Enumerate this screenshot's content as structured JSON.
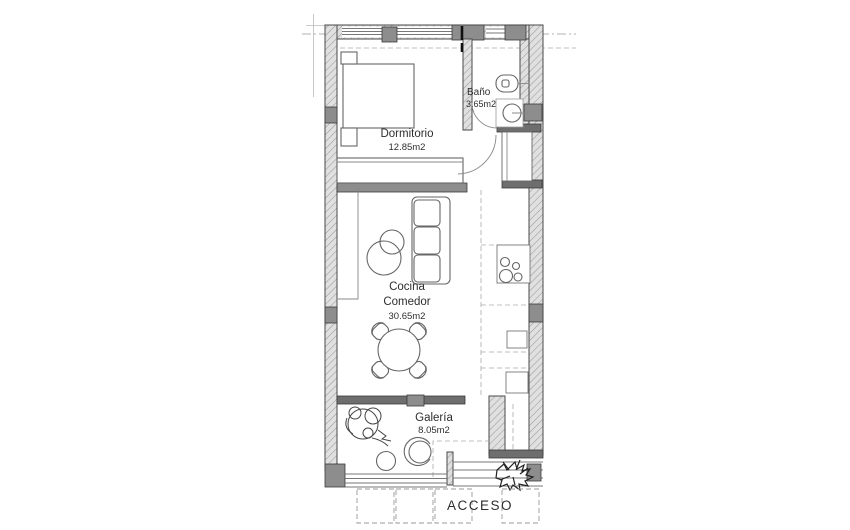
{
  "plan": {
    "rooms": {
      "dormitorio": {
        "name": "Dormitorio",
        "area": "12.85m2"
      },
      "bano": {
        "name": "Baño",
        "area": "3.65m2"
      },
      "cocina_comedor": {
        "name_line1": "Cocina",
        "name_line2": "Comedor",
        "area": "30.65m2"
      },
      "galeria": {
        "name": "Galería",
        "area": "8.05m2"
      }
    },
    "entrance": {
      "label": "ACCESO"
    },
    "colors": {
      "wall_fill": "#8d8d8d",
      "wall_line": "#4a4a4a",
      "text": "#2e2e2e"
    }
  }
}
